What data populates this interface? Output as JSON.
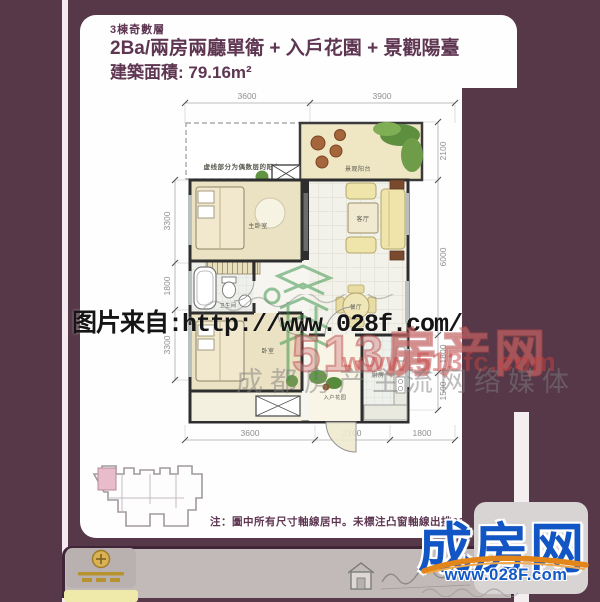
{
  "header": {
    "block_label": "3棟奇數層",
    "title": "2Ba/兩房兩廳單衛 + 入戶花園 + 景觀陽臺",
    "area": "建築面積: 79.16m²"
  },
  "floorplan": {
    "balcony_note": "虚线部分为偶数层的阳台",
    "rooms": {
      "master_bedroom": "主卧室",
      "bedroom": "卧室",
      "bathroom": "卫生间",
      "living": "客厅",
      "dining": "餐厅",
      "kitchen": "厨房",
      "entry_garden": "入户花园",
      "view_balcony": "景观阳台"
    },
    "dims": {
      "top": [
        "3600",
        "3900"
      ],
      "left": [
        "3300",
        "1800",
        "3300"
      ],
      "right": [
        "2100",
        "6000",
        "1800",
        "1500"
      ],
      "bottom": [
        "3600",
        "2100",
        "1800"
      ]
    }
  },
  "watermarks": {
    "source_line": "图片来自:http://www.028f.com/",
    "site_name": "513房产网",
    "site_url": "www.513fc.com",
    "slogan": "成都房产主流网络媒体"
  },
  "footer": {
    "note": "注：圖中所有尺寸軸線居中。未標注凸窗軸線出挑600",
    "brand": "成房网",
    "brand_url": "www.028F.com"
  },
  "colors": {
    "background": "#573848",
    "panel": "#fefefe",
    "title_text": "#5e3652",
    "brand_blue": "#1255c4",
    "swoosh_orange": "#e2861c",
    "watermark_red": "#c64242",
    "unit_highlight_pink": "#e9bccb"
  }
}
